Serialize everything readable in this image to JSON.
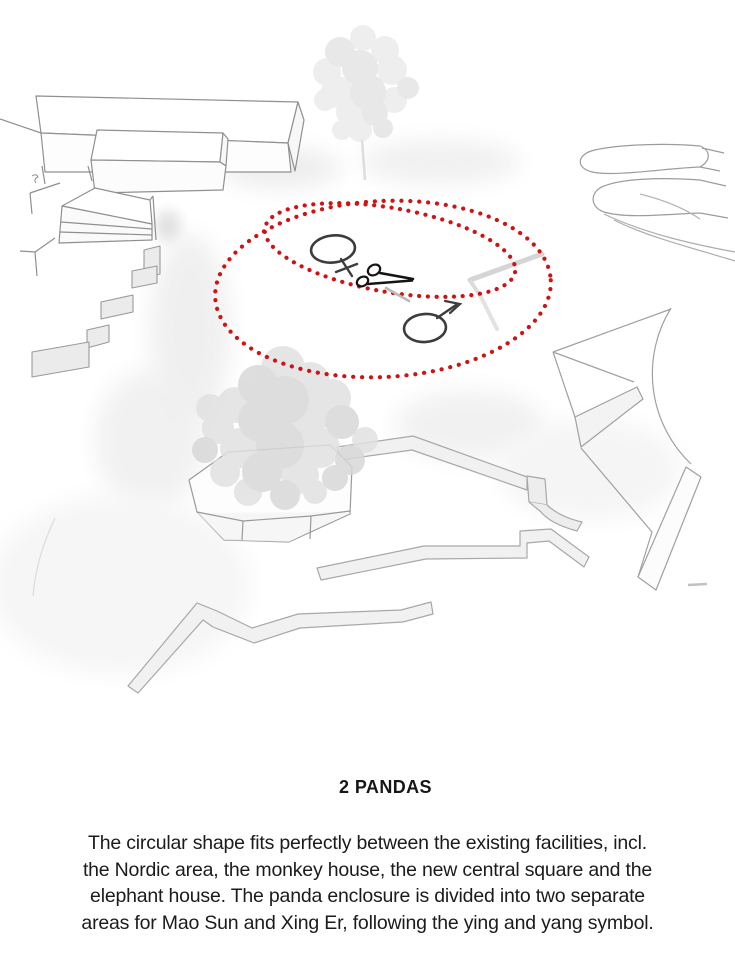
{
  "caption": {
    "title": "2 PANDAS",
    "lines": [
      "The circular shape fits perfectly between the existing facilities, incl.",
      "the Nordic area, the monkey house, the new central square and the",
      "elephant house. The panda enclosure is divided into two separate",
      "areas for Mao Sun and Xing Er, following the ying and yang symbol."
    ]
  },
  "diagram": {
    "description": "Axonometric zoo site sketch with proposed circular panda enclosure",
    "enclosure": {
      "outline_style": "dotted",
      "outline_color": "#cf1212",
      "shape": "two overlapping ellipses (ying-yang division)",
      "areas": [
        {
          "name": "female panda area",
          "symbol_glyph": "♀",
          "panda": "Mao Sun"
        },
        {
          "name": "male panda area",
          "symbol_glyph": "♂",
          "panda": "Xing Er"
        }
      ],
      "divider_icon": "scissors",
      "divider_glyph": "✂"
    },
    "colors": {
      "accent_red": "#cf1212",
      "symbol_stroke": "#3c3c3c",
      "sketch_line": "#9a9a9a"
    }
  }
}
